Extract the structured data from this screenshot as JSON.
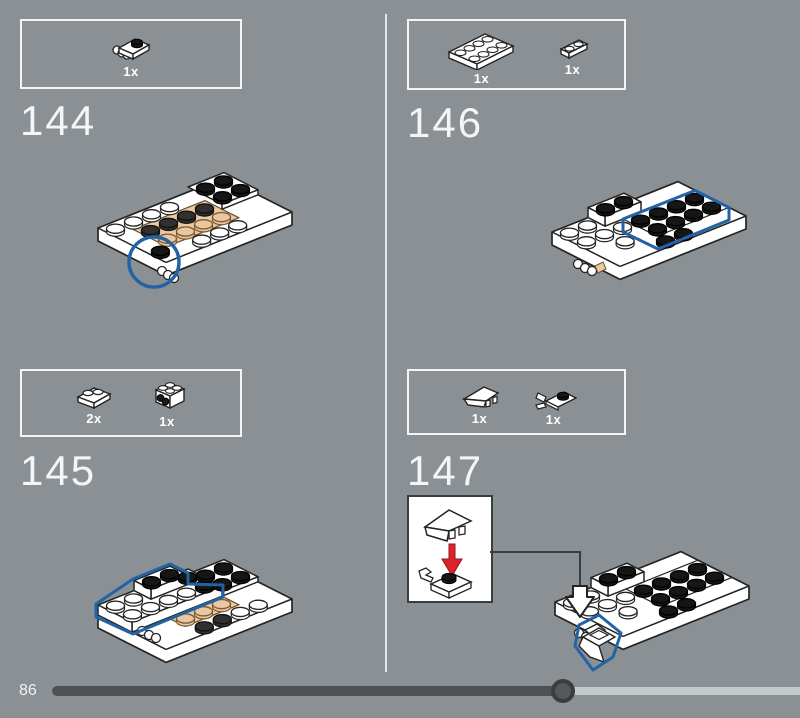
{
  "pagination": {
    "page_number": "86",
    "progress_percent": 68
  },
  "colors": {
    "background": "#8a9093",
    "highlight_blue": "#2263a6",
    "arrow_red": "#d9242b",
    "tan": "#ecc9a3",
    "bar_filled": "#4d5154",
    "bar_rest": "#c3c8cb"
  },
  "steps": {
    "s144": {
      "number": "144",
      "parts": [
        {
          "count": "1x",
          "name": "plate-1x1-with-clip"
        }
      ]
    },
    "s145": {
      "number": "145",
      "parts": [
        {
          "count": "2x",
          "name": "plate-2x2"
        },
        {
          "count": "1x",
          "name": "bracket-2x2"
        }
      ]
    },
    "s146": {
      "number": "146",
      "parts": [
        {
          "count": "1x",
          "name": "plate-2x4"
        },
        {
          "count": "1x",
          "name": "plate-1x2"
        }
      ]
    },
    "s147": {
      "number": "147",
      "parts": [
        {
          "count": "1x",
          "name": "wedge-1x2"
        },
        {
          "count": "1x",
          "name": "plate-1x1-with-clip"
        }
      ]
    }
  }
}
